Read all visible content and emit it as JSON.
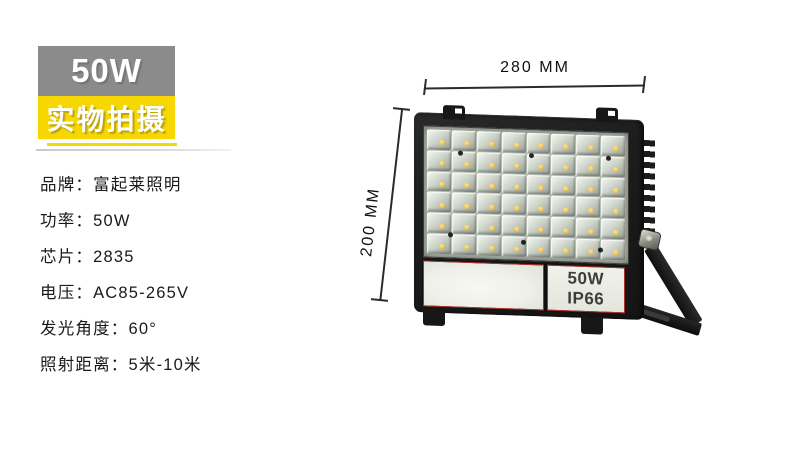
{
  "header": {
    "power_badge": "50W",
    "photo_badge": "实物拍摄"
  },
  "specs": {
    "items": [
      "品牌：富起莱照明",
      "功率：50W",
      "芯片：2835",
      "电压：AC85-265V",
      "发光角度：60°",
      "照射距离：5米-10米"
    ]
  },
  "diagram": {
    "width_label": "280 MM",
    "height_label": "200 MM",
    "lamp": {
      "power_label": "50W",
      "ip_label": "IP66",
      "led_rows": 6,
      "led_cols": 8
    }
  },
  "colors": {
    "page_bg": "#ffffff",
    "power_badge_bg": "#8b8b8b",
    "photo_badge_bg": "#f6d704",
    "badge_text": "#ffffff",
    "spec_text": "#1a1a1a",
    "dimension_line": "#2b2b2b",
    "lamp_frame": "#1d1d1d",
    "led_panel": "#b7bdb3",
    "led_dot": "#f0c24e",
    "diffuser": "#eef0e9",
    "label_text": "#3d3d3d",
    "label_border_red": "#a8342c"
  }
}
